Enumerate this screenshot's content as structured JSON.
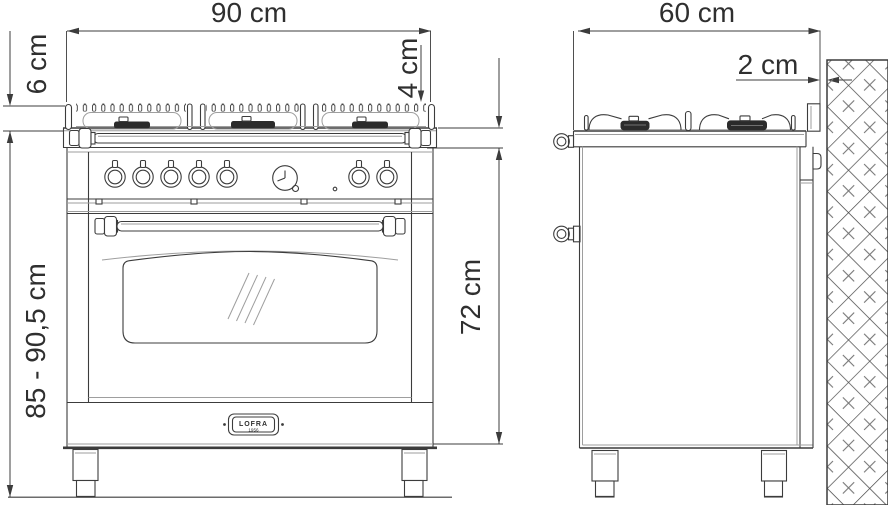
{
  "drawing": {
    "front_view": {
      "width": "90 cm",
      "grate_height": "6 cm",
      "worktop_edge": "4 cm",
      "overall_height": "85 - 90,5 cm",
      "body_height": "72 cm",
      "badge_brand": "LOFRA",
      "badge_year": "1956"
    },
    "side_view": {
      "depth": "60 cm",
      "wall_gap": "2 cm"
    },
    "colors": {
      "line": "#3c3c3c",
      "light_line": "#9e9e9e",
      "text": "#2f2f2f",
      "background": "#ffffff"
    }
  }
}
